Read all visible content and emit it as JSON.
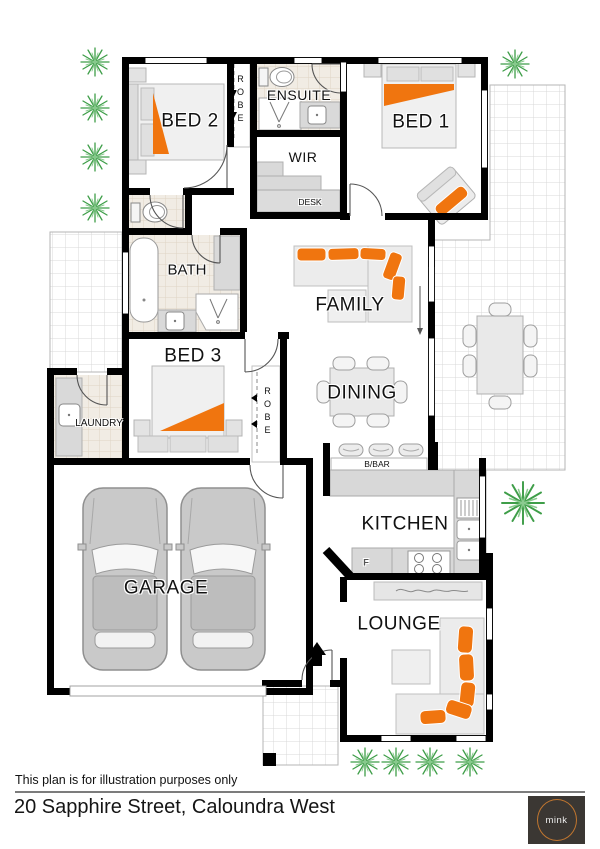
{
  "colors": {
    "accent_orange": "#F0750F",
    "plant_green": "#3F9E49",
    "plant_green_light": "#8BCB90",
    "wall_black": "#000000",
    "logo_bg": "#3B3733",
    "logo_ring": "#C1762F"
  },
  "plan": {
    "rooms": {
      "bed1": "BED 1",
      "bed2": "BED 2",
      "bed3": "BED 3",
      "ensuite": "ENSUITE",
      "wir": "WIR",
      "desk": "DESK",
      "robe": "ROBE",
      "bath": "BATH",
      "laundry": "LAUNDRY",
      "family": "FAMILY",
      "dining": "DINING",
      "breakfast_bar": "B/BAR",
      "kitchen": "KITCHEN",
      "fridge": "F",
      "garage": "GARAGE",
      "lounge": "LOUNGE"
    }
  },
  "footer": {
    "disclaimer": "This plan is for illustration purposes only",
    "address": "20 Sapphire Street, Caloundra West"
  },
  "logo": {
    "text": "mink"
  }
}
